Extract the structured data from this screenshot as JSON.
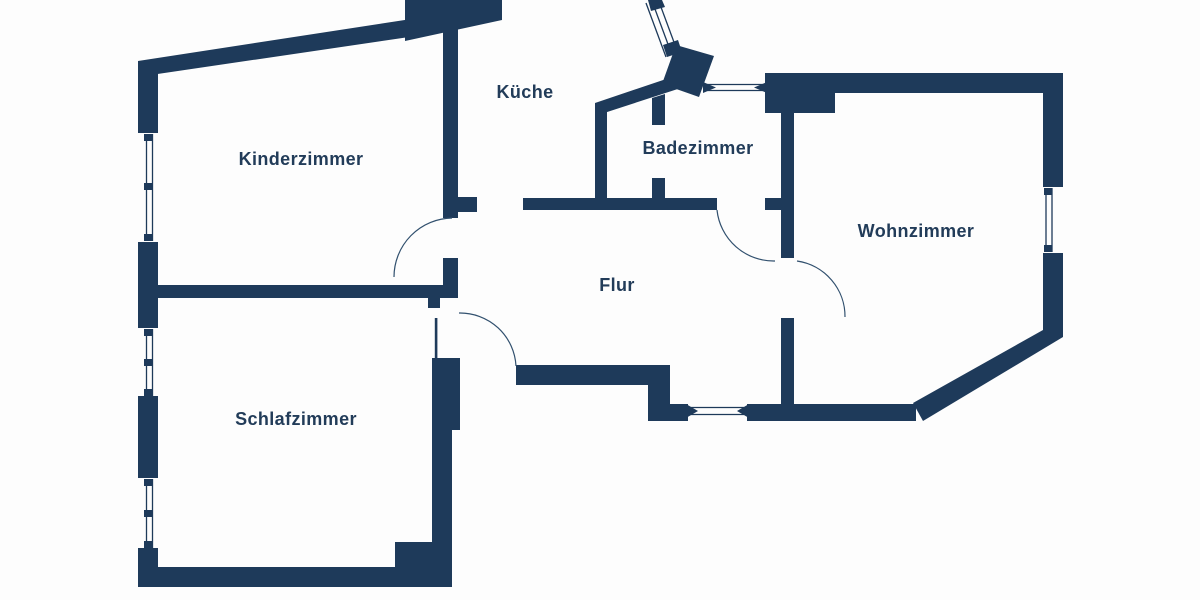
{
  "floorplan": {
    "title": "apartment-floor-plan",
    "canvas": {
      "w": 1200,
      "h": 600,
      "bg": "#fdfdfd"
    },
    "palette": {
      "wall": "#1e3a5a",
      "line": "#31506e",
      "label": "#223c59"
    },
    "rooms": [
      {
        "id": "kinderzimmer",
        "label": "Kinderzimmer",
        "x": 301,
        "y": 165,
        "size": 18
      },
      {
        "id": "kueche",
        "label": "Küche",
        "x": 525,
        "y": 98,
        "size": 18
      },
      {
        "id": "badezimmer",
        "label": "Badezimmer",
        "x": 698,
        "y": 154,
        "size": 18
      },
      {
        "id": "wohnzimmer",
        "label": "Wohnzimmer",
        "x": 916,
        "y": 237,
        "size": 18
      },
      {
        "id": "flur",
        "label": "Flur",
        "x": 617,
        "y": 291,
        "size": 18
      },
      {
        "id": "schlafzimmer",
        "label": "Schlafzimmer",
        "x": 296,
        "y": 425,
        "size": 18
      }
    ],
    "walls": [
      {
        "name": "exterior-top-slanted-wall",
        "pts": "138,61 457,12 457,30 144,76"
      },
      {
        "name": "exterior-top-block",
        "pts": "405,0 502,0 502,20 405,41"
      },
      {
        "name": "left-wall-segment-a",
        "pts": "138,61 158,61 158,133 138,133"
      },
      {
        "name": "left-wall-segment-b",
        "pts": "138,242 158,242 158,328 138,328"
      },
      {
        "name": "left-wall-segment-c",
        "pts": "138,396 158,396 158,478 138,478"
      },
      {
        "name": "left-wall-segment-d",
        "pts": "138,548 158,548 158,587 138,587"
      },
      {
        "name": "kinder-schlaf-dividing-wall",
        "pts": "152,285 458,285 458,298 152,298"
      },
      {
        "name": "kinder-right-wall",
        "pts": "443,24 458,24 458,218 443,218"
      },
      {
        "name": "kueche-entry-stub",
        "pts": "458,197 477,197 477,212 458,212"
      },
      {
        "name": "kinder-right-wall-lower",
        "pts": "443,258 458,258 458,298 443,298"
      },
      {
        "name": "flur-top-wall",
        "pts": "523,198 717,198 717,210 523,210"
      },
      {
        "name": "bad-west-wall",
        "pts": "595,103 607,103 607,210 595,210"
      },
      {
        "name": "bad-slanted-wall",
        "pts": "595,103 681,74 687,86 601,114"
      },
      {
        "name": "bad-partition-stub-upper",
        "pts": "652,98 665,94 665,125 652,125"
      },
      {
        "name": "bad-partition-stub-lower",
        "pts": "652,178 665,178 665,210 652,210"
      },
      {
        "name": "entry-angled-block",
        "pts": "676,45 714,56 699,97 662,84"
      },
      {
        "name": "entry-window-tick-top",
        "pts": "648,0 662,0 665,7 651,11"
      },
      {
        "name": "entry-window-tick-bottom",
        "pts": "663,45 678,40 682,52 667,57"
      },
      {
        "name": "top-window-wedge-left",
        "pts": "703,82 716,87.5 703,93"
      },
      {
        "name": "top-window-wedge-right",
        "pts": "767,82 754,87.5 767,93"
      },
      {
        "name": "wohn-nw-corner-block",
        "pts": "765,73 835,73 835,113 765,113"
      },
      {
        "name": "wohn-north-wall",
        "pts": "765,73 1063,73 1063,93 765,93"
      },
      {
        "name": "wohn-ne-corner-block",
        "pts": "1043,73 1063,73 1063,187 1043,187"
      },
      {
        "name": "wohn-right-wall",
        "pts": "1043,253 1063,253 1063,337 1043,337"
      },
      {
        "name": "wohn-diagonal-wall",
        "pts": "1043,330 1063,337 923,421 913,403"
      },
      {
        "name": "wohn-bottom-wall",
        "pts": "747,404 916,404 916,421 747,421"
      },
      {
        "name": "flur-wohn-wall-upper",
        "pts": "781,113 794,113 794,258 781,258"
      },
      {
        "name": "flur-wohn-stub",
        "pts": "765,198 781,198 781,210 765,210"
      },
      {
        "name": "flur-wohn-wall-lower",
        "pts": "781,318 794,318 794,415 781,415"
      },
      {
        "name": "flur-bottom-wall",
        "pts": "516,365 670,365 670,385 516,385"
      },
      {
        "name": "flur-step-wall",
        "pts": "648,385 670,385 670,421 648,421"
      },
      {
        "name": "nook-wall-block",
        "pts": "670,404 688,404 688,421 670,421"
      },
      {
        "name": "nook-window-wedge-left",
        "pts": "686,404 698,411 686,418"
      },
      {
        "name": "nook-window-wedge-right",
        "pts": "749,404 737,411 749,418"
      },
      {
        "name": "schlaf-door-stub",
        "pts": "428,298 440,298 440,308 428,308"
      },
      {
        "name": "schlaf-right-wall-upper",
        "pts": "432,358 460,358 460,430 432,430"
      },
      {
        "name": "schlaf-right-wall",
        "pts": "432,430 452,430 452,587 432,587"
      },
      {
        "name": "schlaf-se-corner-block",
        "pts": "395,542 452,542 452,587 395,587"
      },
      {
        "name": "schlaf-bottom-wall",
        "pts": "138,567 400,567 400,587 138,587"
      }
    ],
    "window_lines": [
      {
        "name": "kinder-window",
        "x1": 146.5,
        "y1": 134,
        "x2": 146.5,
        "y2": 241
      },
      {
        "name": "kinder-window",
        "x1": 152.5,
        "y1": 134,
        "x2": 152.5,
        "y2": 241
      },
      {
        "name": "schlaf-window-1",
        "x1": 146.5,
        "y1": 329,
        "x2": 146.5,
        "y2": 396
      },
      {
        "name": "schlaf-window-1",
        "x1": 152.5,
        "y1": 329,
        "x2": 152.5,
        "y2": 396
      },
      {
        "name": "schlaf-window-2",
        "x1": 146.5,
        "y1": 479,
        "x2": 146.5,
        "y2": 548
      },
      {
        "name": "schlaf-window-2",
        "x1": 152.5,
        "y1": 479,
        "x2": 152.5,
        "y2": 548
      },
      {
        "name": "wohn-window",
        "x1": 1046,
        "y1": 188,
        "x2": 1046,
        "y2": 252
      },
      {
        "name": "wohn-window",
        "x1": 1052,
        "y1": 188,
        "x2": 1052,
        "y2": 252
      },
      {
        "name": "bad-top-window",
        "x1": 707,
        "y1": 84.5,
        "x2": 763,
        "y2": 84.5
      },
      {
        "name": "bad-top-window",
        "x1": 707,
        "y1": 90.5,
        "x2": 763,
        "y2": 90.5
      },
      {
        "name": "nook-window",
        "x1": 690,
        "y1": 407.5,
        "x2": 744,
        "y2": 407.5
      },
      {
        "name": "nook-window",
        "x1": 690,
        "y1": 414.5,
        "x2": 744,
        "y2": 414.5
      },
      {
        "name": "entry-diag-window",
        "x1": 646,
        "y1": 3,
        "x2": 666,
        "y2": 57
      },
      {
        "name": "entry-diag-window",
        "x1": 652,
        "y1": 1,
        "x2": 672,
        "y2": 55
      },
      {
        "name": "entry-diag-window",
        "x1": 658,
        "y1": -1,
        "x2": 678,
        "y2": 53
      }
    ],
    "window_ticks": [
      {
        "x": 144,
        "y": 134,
        "w": 8,
        "h": 7
      },
      {
        "x": 144,
        "y": 183,
        "w": 8,
        "h": 7
      },
      {
        "x": 144,
        "y": 234,
        "w": 8,
        "h": 7
      },
      {
        "x": 144,
        "y": 329,
        "w": 8,
        "h": 7
      },
      {
        "x": 144,
        "y": 359,
        "w": 8,
        "h": 7
      },
      {
        "x": 144,
        "y": 389,
        "w": 8,
        "h": 7
      },
      {
        "x": 144,
        "y": 479,
        "w": 8,
        "h": 7
      },
      {
        "x": 144,
        "y": 510,
        "w": 8,
        "h": 7
      },
      {
        "x": 144,
        "y": 541,
        "w": 8,
        "h": 7
      },
      {
        "x": 1044,
        "y": 188,
        "w": 8,
        "h": 7
      },
      {
        "x": 1044,
        "y": 245,
        "w": 8,
        "h": 7
      }
    ],
    "door_arcs": [
      {
        "name": "kinder-door-arc",
        "d": "M 394 277 A 59 59 0 0 1 452 218"
      },
      {
        "name": "schlaf-door-arc",
        "d": "M 459 313 A 56 56 0 0 1 516 366"
      },
      {
        "name": "bad-door-arc",
        "d": "M 717 210 A 57 57 0 0 0 775 261"
      },
      {
        "name": "wohn-door-arc",
        "d": "M 797 261 A 56 56 0 0 1 845 317"
      }
    ],
    "door_leaves": [
      {
        "name": "schlaf-door-leaf",
        "x": 434.8,
        "y": 318,
        "w": 2.6,
        "h": 40
      }
    ]
  }
}
